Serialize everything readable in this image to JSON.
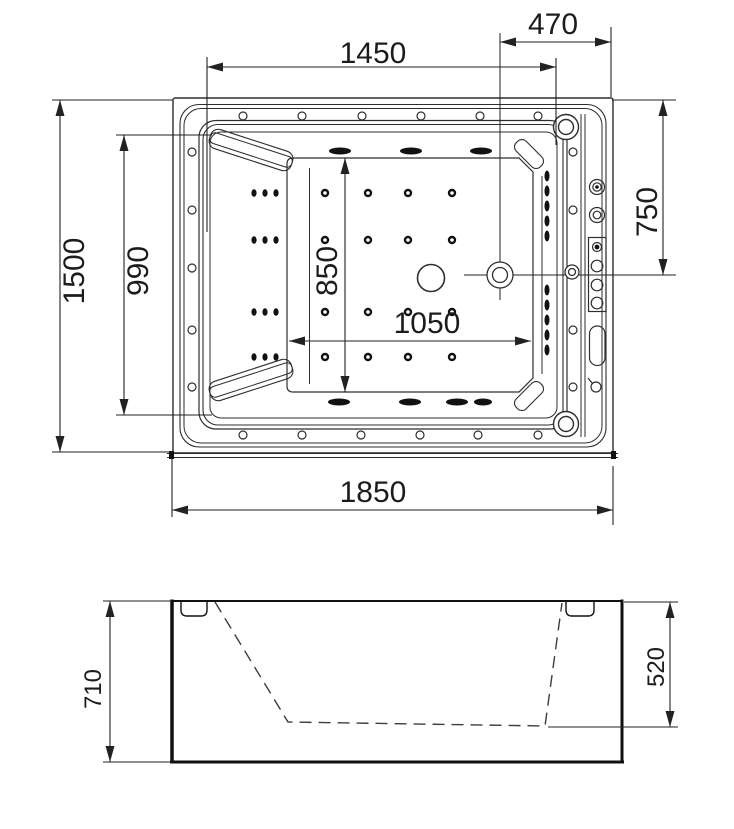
{
  "colors": {
    "line": "#2e2e2e",
    "thin_line": "#3a3a3a",
    "dim_line": "#222222",
    "bold_line": "#111111",
    "fill_dark": "#111111",
    "background": "#ffffff"
  },
  "icons": {
    "drain": "drain-circle",
    "whirlpool_jet": "jet-crosshair-circle",
    "corner_jet": "corner-jet-circle",
    "wall_jet": "wall-jet-circle",
    "floor_jet": "floor-jet-dot",
    "air_jet_group": "air-jet-triple-dot",
    "water_oval_jet": "oval-jet",
    "control_panel": "control-panel",
    "overflow_slot": "overflow-pill"
  },
  "top_view": {
    "dims": {
      "overall_width": "1850",
      "overall_depth": "1500",
      "rim_length": "1450",
      "deck_width": "470",
      "inner_depth": "990",
      "jet_height_offset": "750",
      "floor_length": "1050",
      "floor_depth": "850"
    }
  },
  "side_view": {
    "dims": {
      "overall_height": "710",
      "inner_height": "520"
    }
  }
}
